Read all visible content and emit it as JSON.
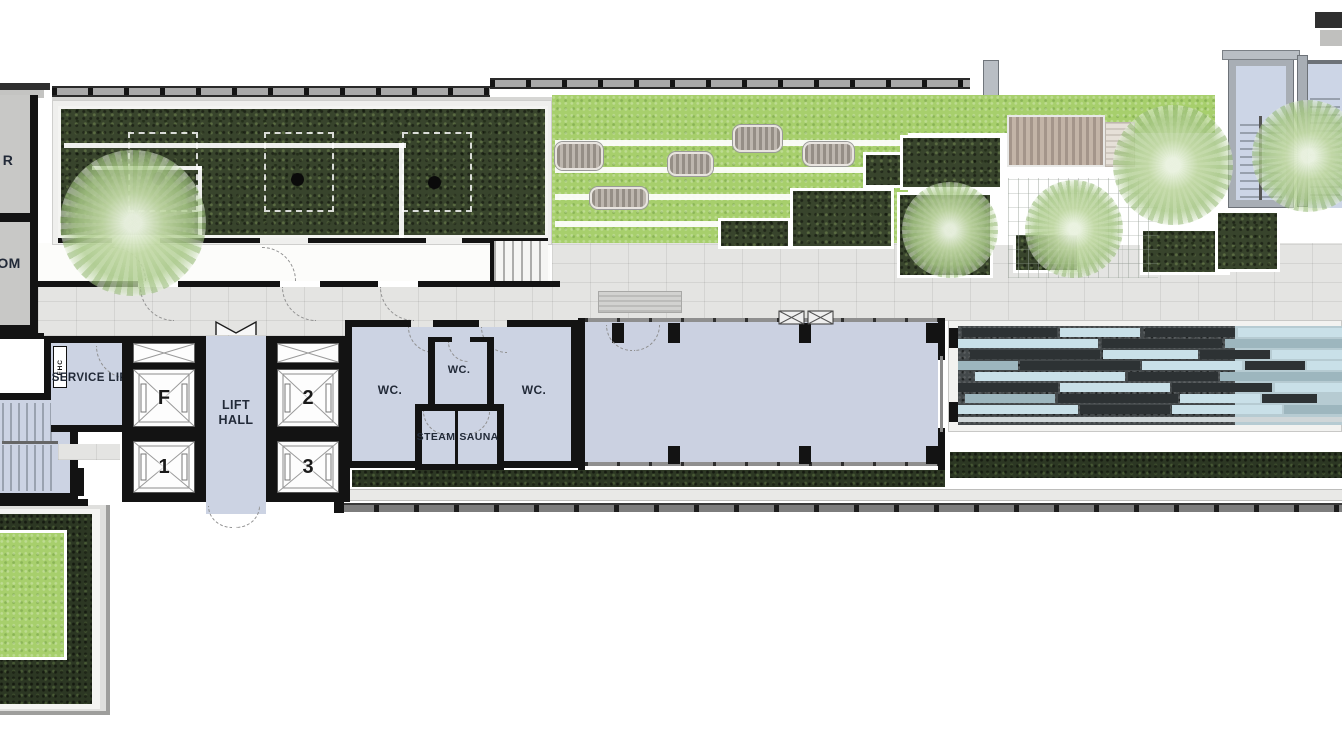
{
  "plan": {
    "type": "architectural-floor-plan",
    "labels": {
      "left_room_top": "R",
      "left_room_bottom": "OM",
      "fire_hose_cabinet": "FHC",
      "service_lift": "SERVICE LIFT",
      "lift_hall": "LIFT HALL",
      "lift_f": "F",
      "lift_1": "1",
      "lift_2": "2",
      "lift_3": "3",
      "wc_left": "WC.",
      "wc_middle": "WC.",
      "wc_right": "WC.",
      "steam": "STEAM",
      "sauna": "SAUNA"
    },
    "colors": {
      "wall": "#141414",
      "room_floor": "#ccd3e3",
      "paving": "#e4e4e2",
      "indoor_floor": "#fcfcfa",
      "hedge_dark": "#38442c",
      "lawn_bright": "#a7cf6c",
      "tree_foliage": "#b9d49a",
      "pool_stone_dark": "#43484a",
      "pool_water_light": "#c9e0e8",
      "deck_wood": "#b3a294",
      "stair_floor": "#ccd5e6",
      "label_text": "#222a38"
    }
  }
}
